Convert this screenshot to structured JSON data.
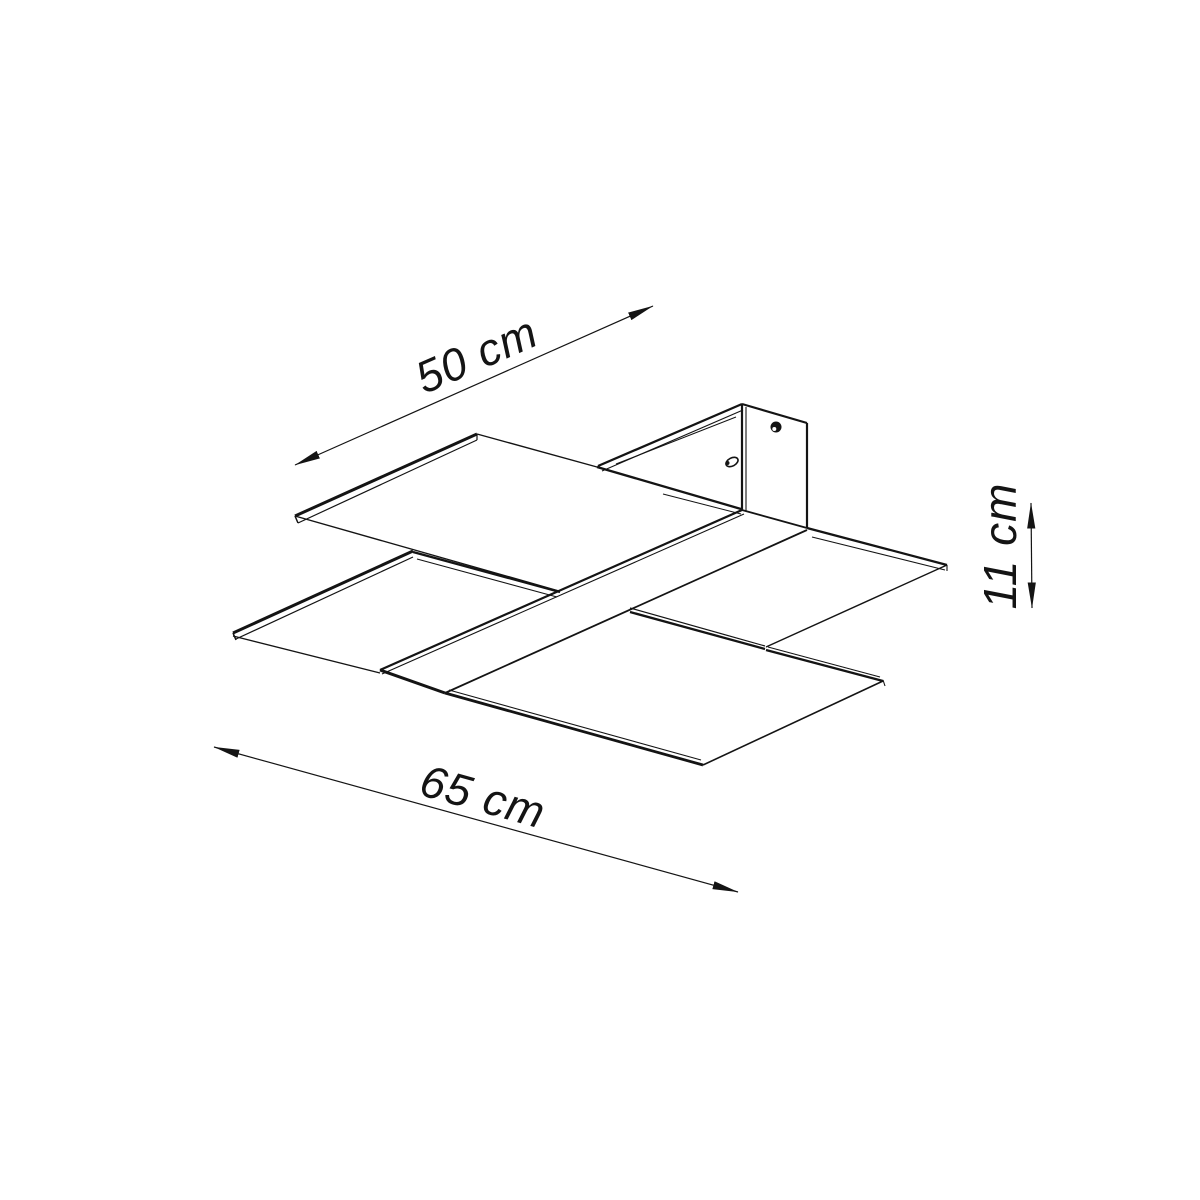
{
  "diagram": {
    "type": "product-dimension-drawing",
    "subject": "two-plate ceiling lamp, isometric wireframe",
    "labels": {
      "depth": "50 cm",
      "width": "65 cm",
      "height": "11 cm"
    },
    "colors": {
      "line": "#141414",
      "background": "#ffffff"
    },
    "parts": [
      "upper-glass-panel",
      "lower-glass-panel",
      "diagonal-strap",
      "ceiling-bracket",
      "mounting-channel",
      "screw-hole",
      "wire-hole"
    ]
  }
}
